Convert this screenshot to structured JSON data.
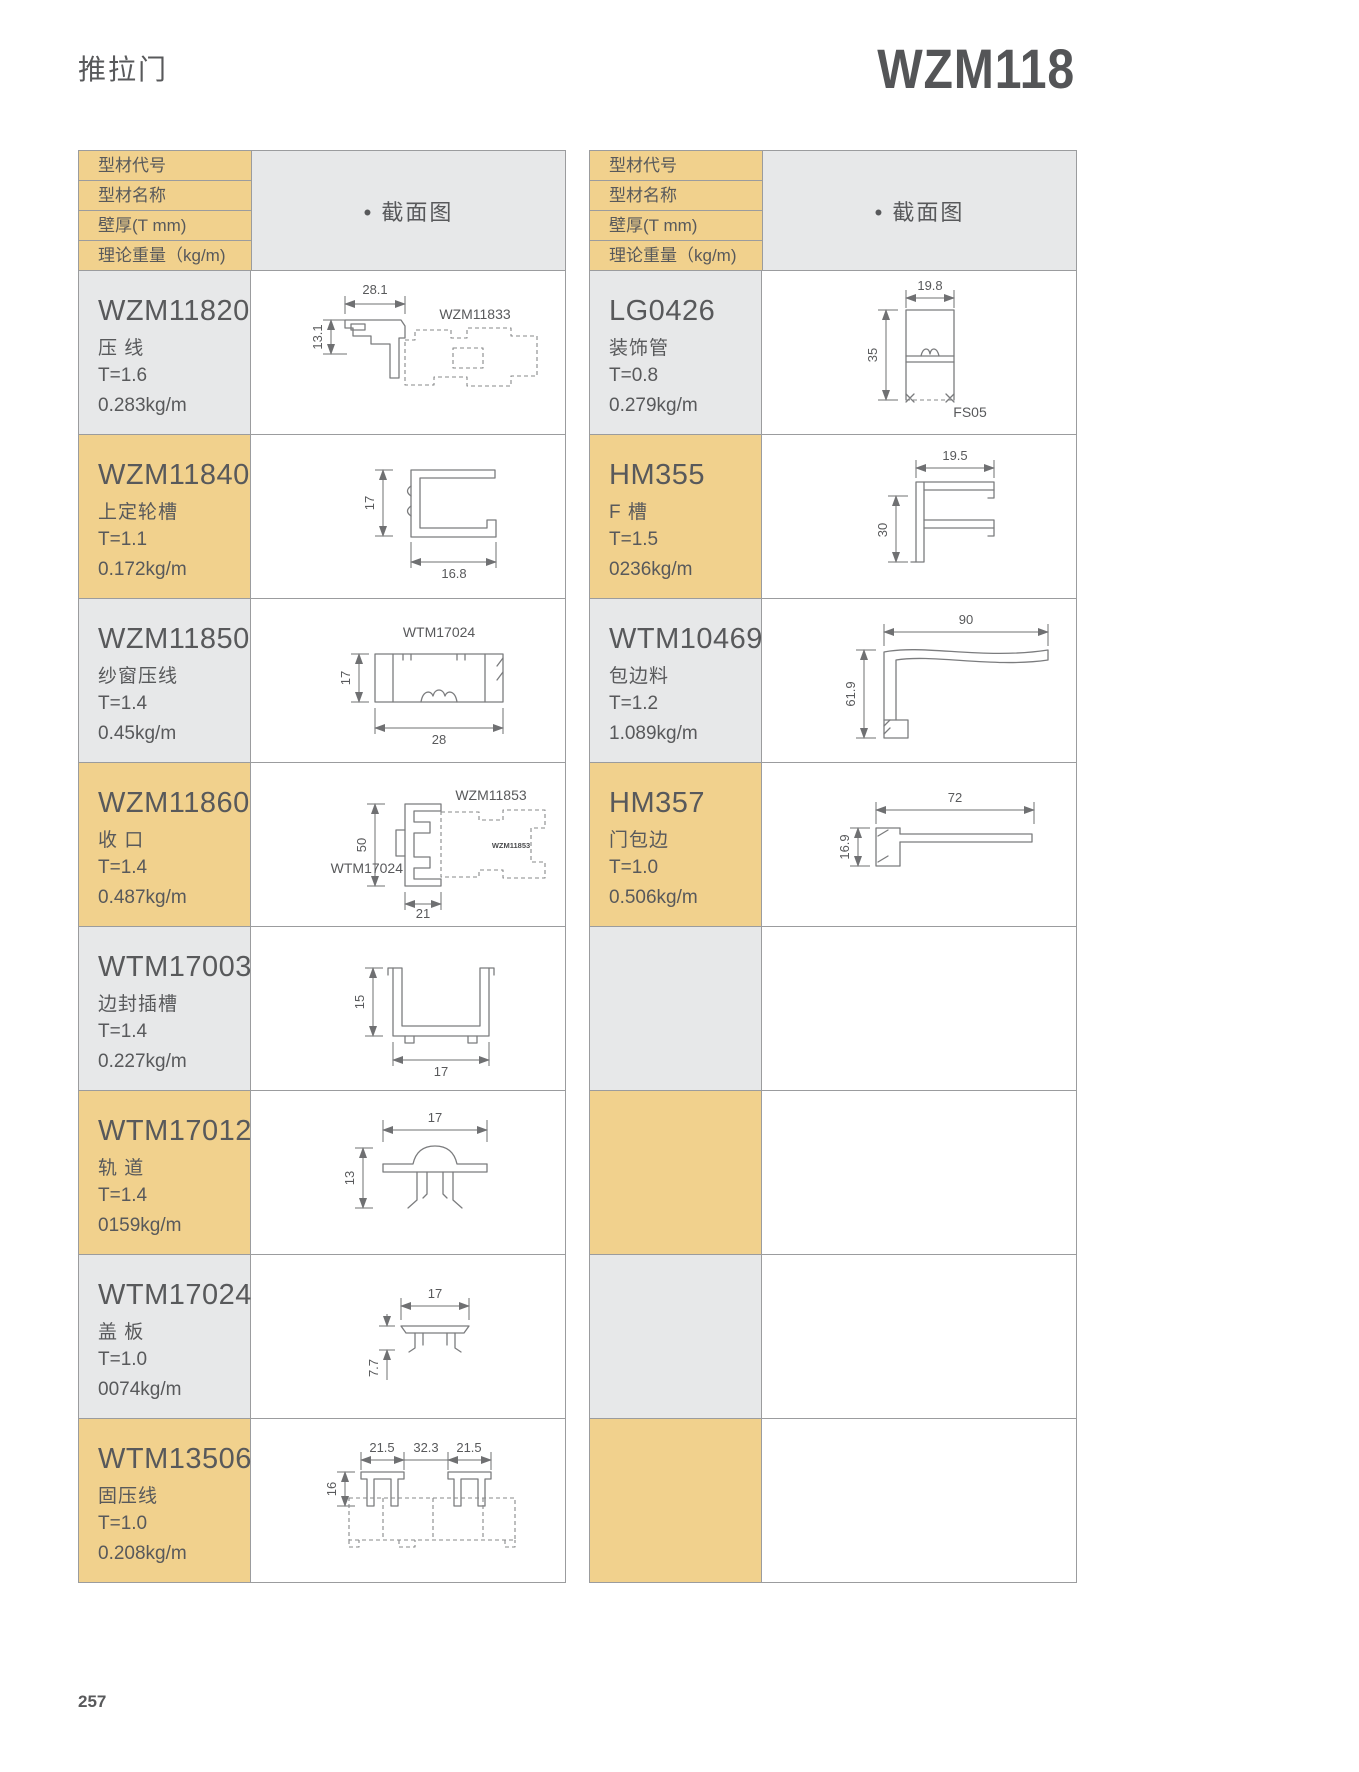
{
  "page": {
    "category": "推拉门",
    "model": "WZM118",
    "page_number": "257"
  },
  "header": {
    "row_labels": [
      "型材代号",
      "型材名称",
      "壁厚(T mm)",
      "理论重量（kg/m)"
    ],
    "section_label": "• 截面图"
  },
  "colors": {
    "accent_yellow": "#F1D18D",
    "cell_grey": "#E7E8E9",
    "border": "#9b9c9e",
    "text": "#58595B"
  },
  "left_rows": [
    {
      "code": "WZM11820",
      "name": "压 线",
      "thickness": "T=1.6",
      "weight": "0.283kg/m",
      "diagram": {
        "dim_width": "28.1",
        "dim_height": "13.1",
        "ref_label": "WZM11833"
      }
    },
    {
      "code": "WZM11840",
      "name": "上定轮槽",
      "thickness": "T=1.1",
      "weight": "0.172kg/m",
      "diagram": {
        "dim_height": "17",
        "dim_width": "16.8"
      }
    },
    {
      "code": "WZM11850",
      "name": "纱窗压线",
      "thickness": "T=1.4",
      "weight": "0.45kg/m",
      "diagram": {
        "ref_label": "WTM17024",
        "dim_height": "17",
        "dim_width": "28"
      }
    },
    {
      "code": "WZM11860",
      "name": "收 口",
      "thickness": "T=1.4",
      "weight": "0.487kg/m",
      "diagram": {
        "ref_label": "WZM11853",
        "ref_label2": "WTM17024",
        "stamp": "WZM11853",
        "dim_height": "50",
        "dim_width": "21"
      }
    },
    {
      "code": "WTM17003",
      "name": "边封插槽",
      "thickness": "T=1.4",
      "weight": "0.227kg/m",
      "diagram": {
        "dim_height": "15",
        "dim_width": "17"
      }
    },
    {
      "code": "WTM17012",
      "name": "轨 道",
      "thickness": "T=1.4",
      "weight": "0159kg/m",
      "diagram": {
        "dim_width": "17",
        "dim_height": "13"
      }
    },
    {
      "code": "WTM17024",
      "name": "盖 板",
      "thickness": "T=1.0",
      "weight": "0074kg/m",
      "diagram": {
        "dim_width": "17",
        "dim_height": "7.7"
      }
    },
    {
      "code": "WTM13506",
      "name": "固压线",
      "thickness": "T=1.0",
      "weight": "0.208kg/m",
      "diagram": {
        "dim_w1": "21.5",
        "dim_w2": "32.3",
        "dim_w3": "21.5",
        "dim_height": "16"
      }
    }
  ],
  "right_rows": [
    {
      "code": "LG0426",
      "name": "装饰管",
      "thickness": "T=0.8",
      "weight": "0.279kg/m",
      "diagram": {
        "dim_width": "19.8",
        "dim_height": "35",
        "ref_label": "FS05"
      }
    },
    {
      "code": "HM355",
      "name": "F 槽",
      "thickness": "T=1.5",
      "weight": "0236kg/m",
      "diagram": {
        "dim_width": "19.5",
        "dim_height": "30"
      }
    },
    {
      "code": "WTM10469",
      "name": "包边料",
      "thickness": "T=1.2",
      "weight": "1.089kg/m",
      "diagram": {
        "dim_width": "90",
        "dim_height": "61.9"
      }
    },
    {
      "code": "HM357",
      "name": "门包边",
      "thickness": "T=1.0",
      "weight": "0.506kg/m",
      "diagram": {
        "dim_width": "72",
        "dim_height": "16.9"
      }
    },
    {
      "code": "",
      "name": "",
      "thickness": "",
      "weight": ""
    },
    {
      "code": "",
      "name": "",
      "thickness": "",
      "weight": ""
    },
    {
      "code": "",
      "name": "",
      "thickness": "",
      "weight": ""
    },
    {
      "code": "",
      "name": "",
      "thickness": "",
      "weight": ""
    }
  ]
}
